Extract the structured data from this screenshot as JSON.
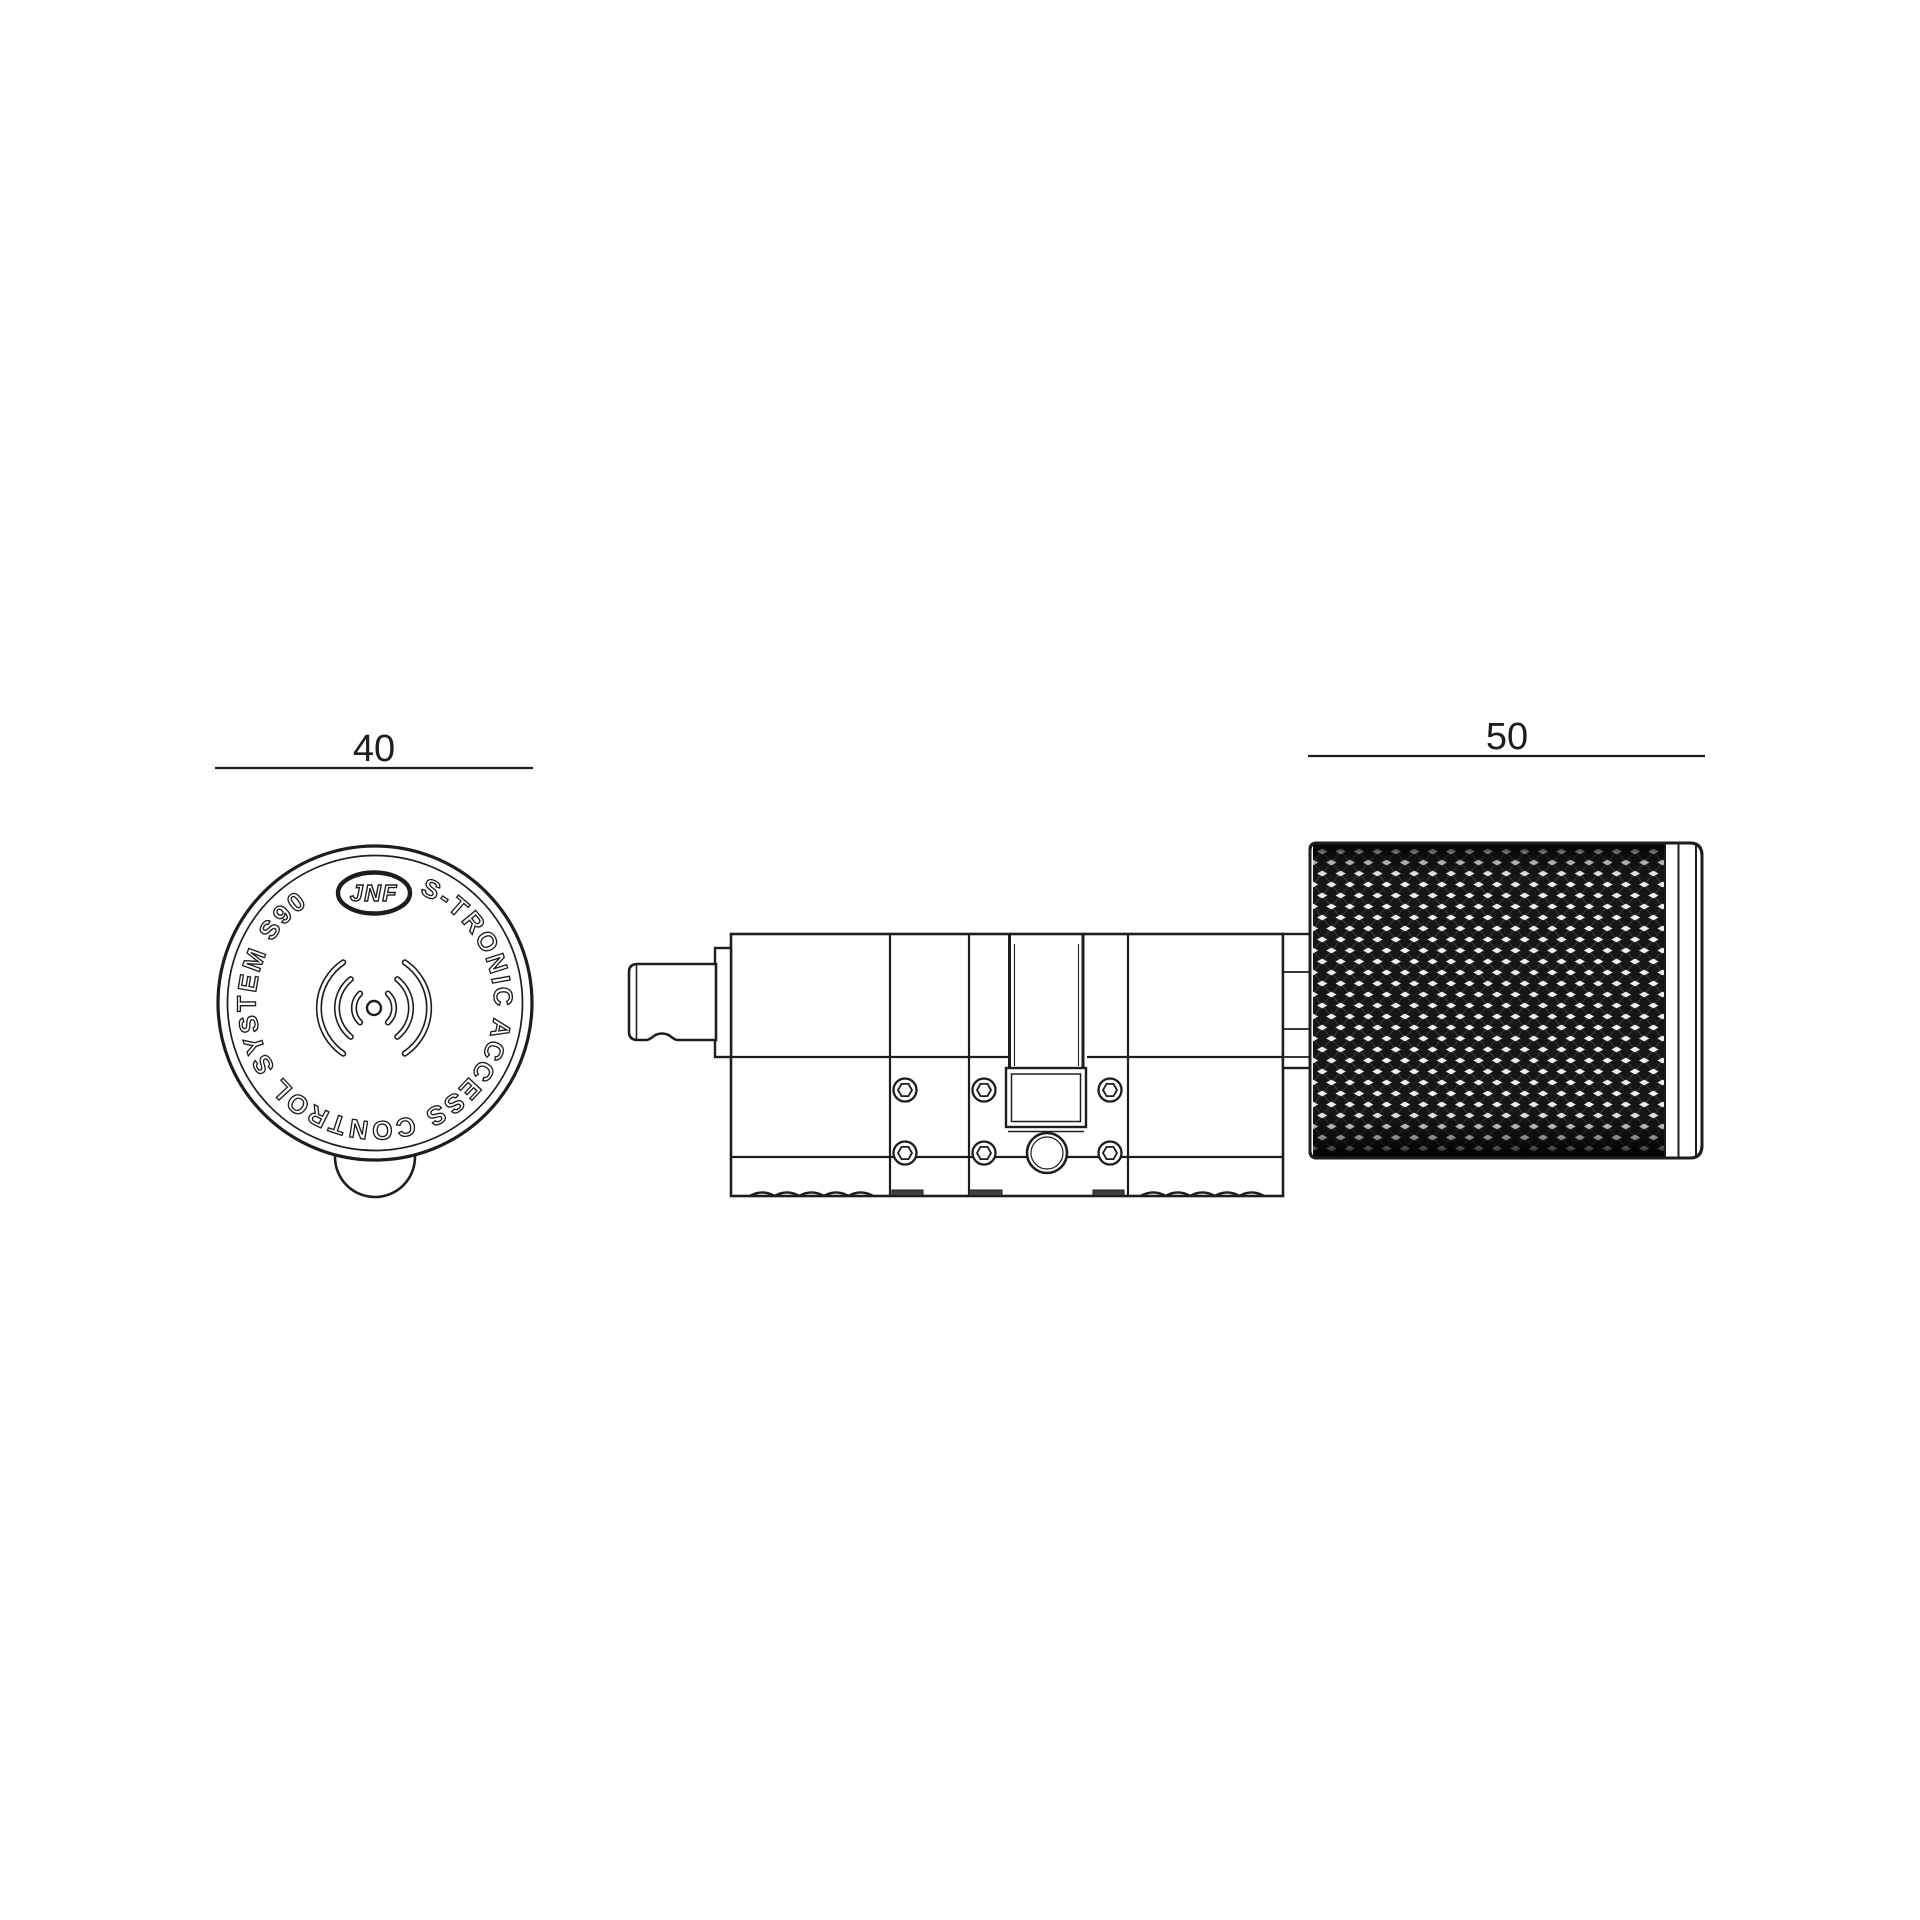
{
  "colors": {
    "background": "#ffffff",
    "surface": "#ffffff",
    "line": "#1d1d1b",
    "knurl_base": "#161616",
    "knurl_highlight": "#ffffff",
    "foot_fill": "#3f3f3f"
  },
  "dimensions": {
    "front_diameter": {
      "label": "40"
    },
    "knob_length": {
      "label": "50"
    }
  },
  "front_view": {
    "ring_text": "S-TRONIC ACCESS CONTROL SYSTEM S90",
    "logo_text": "JNF",
    "center_icon": "wifi-signal-icon"
  }
}
